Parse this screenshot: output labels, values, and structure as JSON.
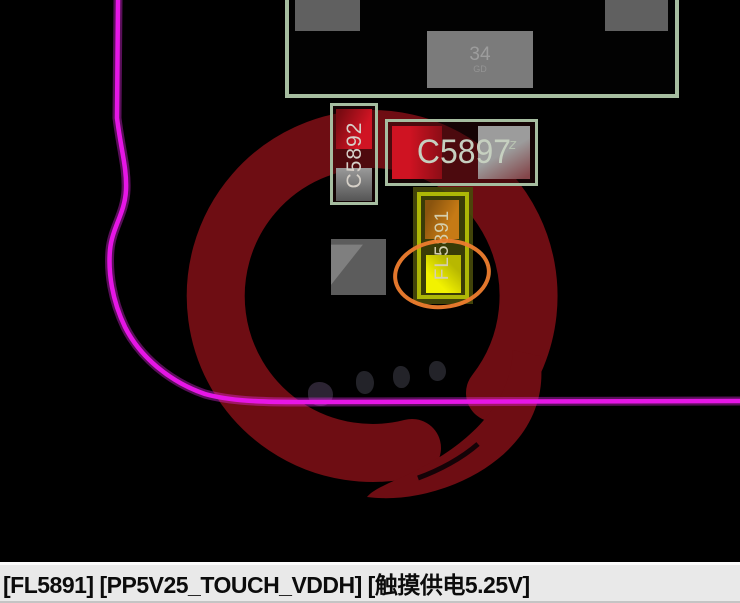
{
  "board": {
    "background_color": "#000000",
    "watermark_color": "#6e0d13",
    "outline_color": "#e616e6",
    "highlight_color": "#ee7d2e",
    "silkscreen_color": "#a6bda0",
    "pad_red": "#cf1322",
    "pad_yellow": "#e8e800",
    "pad_orange": "#c27714"
  },
  "components": {
    "c5892": {
      "label": "C5892"
    },
    "c5897": {
      "label": "C5897",
      "sub_label": "z"
    },
    "fl5891": {
      "label": "FL5891"
    },
    "top_pad": {
      "value": "34",
      "sub_value": "GD"
    }
  },
  "status_bar": {
    "text": "[FL5891] [PP5V25_TOUCH_VDDH] [触摸供电5.25V]"
  }
}
